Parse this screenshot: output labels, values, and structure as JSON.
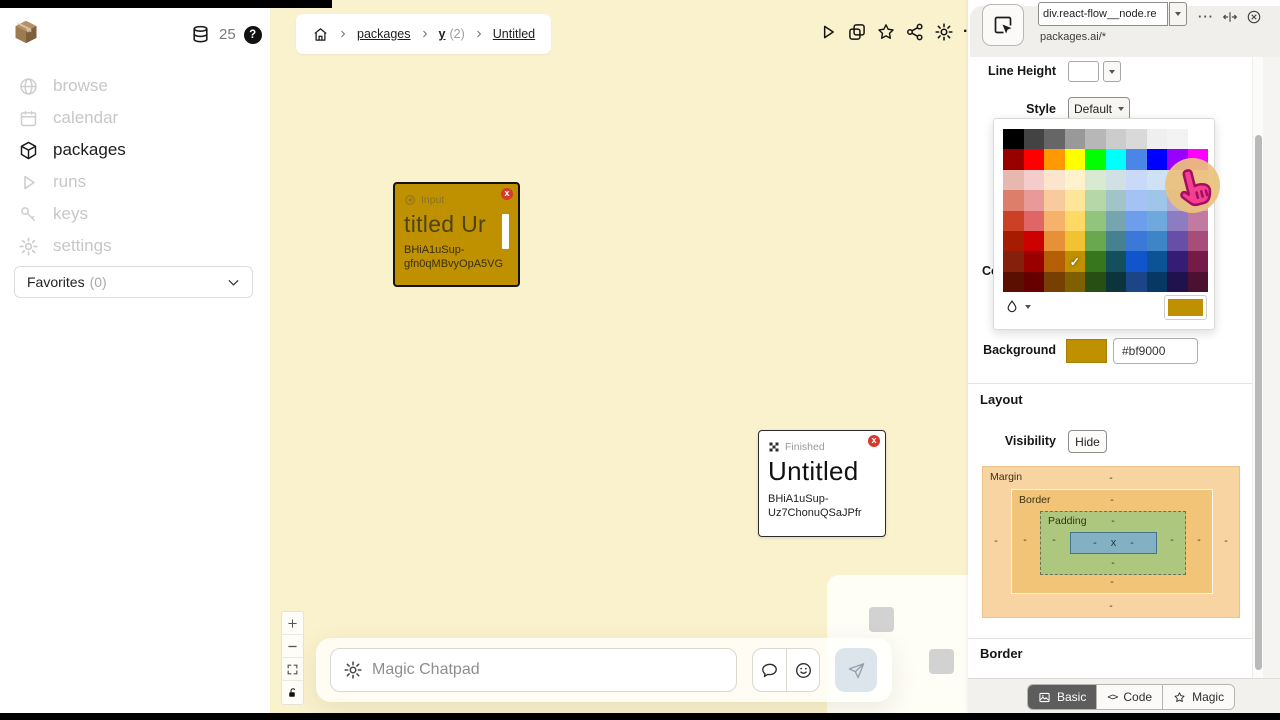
{
  "icons": {
    "check": "✓",
    "dots": "···",
    "code": "<>",
    "overflow_dot": "·",
    "question": "?",
    "close_x": "x"
  },
  "sidebar": {
    "counter": "25",
    "items": [
      {
        "label": "browse"
      },
      {
        "label": "calendar"
      },
      {
        "label": "packages"
      },
      {
        "label": "runs"
      },
      {
        "label": "keys"
      },
      {
        "label": "settings"
      }
    ],
    "favorites_label": "Favorites",
    "favorites_count": "(0)"
  },
  "breadcrumb": {
    "separator": ">",
    "item_packages": "packages",
    "item_group": "y",
    "item_group_count": "(2)",
    "item_current": "Untitled"
  },
  "canvas": {
    "nodes": [
      {
        "badge": "Input",
        "title": "titled Ur",
        "id_line1": "BHiA1uSup-",
        "id_line2": "gfn0qMBvyOpA5VG",
        "bg": "#bf9000"
      },
      {
        "badge": "Finished",
        "title": "Untitled",
        "id_line1": "BHiA1uSup-",
        "id_line2": "Uz7ChonuQSaJPfr",
        "bg": "#ffffff"
      }
    ],
    "chatpad": {
      "placeholder": "Magic Chatpad"
    }
  },
  "inspector": {
    "selector_value": "div.react-flow__node.re",
    "scope": "packages.ai/*",
    "line_height_label": "Line Height",
    "style_label": "Style",
    "style_value": "Default",
    "color_label": "Color",
    "background_label": "Background",
    "background_value": "#bf9000",
    "layout_heading": "Layout",
    "visibility_label": "Visibility",
    "visibility_button": "Hide",
    "box_model": {
      "margin_label": "Margin",
      "border_label": "Border",
      "padding_label": "Padding",
      "dash": "-",
      "content": "x"
    },
    "border_heading": "Border",
    "tabs": [
      {
        "label": "Basic",
        "active": true
      },
      {
        "label": "Code",
        "active": false
      },
      {
        "label": "Magic",
        "active": false
      }
    ],
    "palette": {
      "selected_row": 6,
      "selected_col": 3,
      "rows": [
        [
          "#000000",
          "#434343",
          "#666666",
          "#999999",
          "#b7b7b7",
          "#cccccc",
          "#d9d9d9",
          "#efefef",
          "#f3f3f3",
          "#ffffff"
        ],
        [
          "#980000",
          "#ff0000",
          "#ff9900",
          "#ffff00",
          "#00ff00",
          "#00ffff",
          "#4a86e8",
          "#0000ff",
          "#9900ff",
          "#ff00ff"
        ],
        [
          "#e6b8af",
          "#f4cccc",
          "#fce5cd",
          "#fff2cc",
          "#d9ead3",
          "#d0e0e3",
          "#c9daf8",
          "#cfe2f3",
          "#d9d2e9",
          "#ead1dc"
        ],
        [
          "#dd7e6b",
          "#ea9999",
          "#f9cb9c",
          "#ffe599",
          "#b6d7a8",
          "#a2c4c9",
          "#a4c2f4",
          "#9fc5e8",
          "#b4a7d6",
          "#d5a6bd"
        ],
        [
          "#cc4125",
          "#e06666",
          "#f6b26b",
          "#ffd966",
          "#93c47d",
          "#76a5af",
          "#6d9eeb",
          "#6fa8dc",
          "#8e7cc3",
          "#c27ba0"
        ],
        [
          "#a61c00",
          "#cc0000",
          "#e69138",
          "#f1c232",
          "#6aa84f",
          "#45818e",
          "#3c78d8",
          "#3d85c6",
          "#674ea7",
          "#a64d79"
        ],
        [
          "#85200c",
          "#990000",
          "#b45f06",
          "#bf9000",
          "#38761d",
          "#134f5c",
          "#1155cc",
          "#0b5394",
          "#351c75",
          "#741b47"
        ],
        [
          "#5b0f00",
          "#660000",
          "#783f04",
          "#7f6000",
          "#274e13",
          "#0c343d",
          "#1c4587",
          "#073763",
          "#20124d",
          "#4c1130"
        ]
      ]
    }
  }
}
